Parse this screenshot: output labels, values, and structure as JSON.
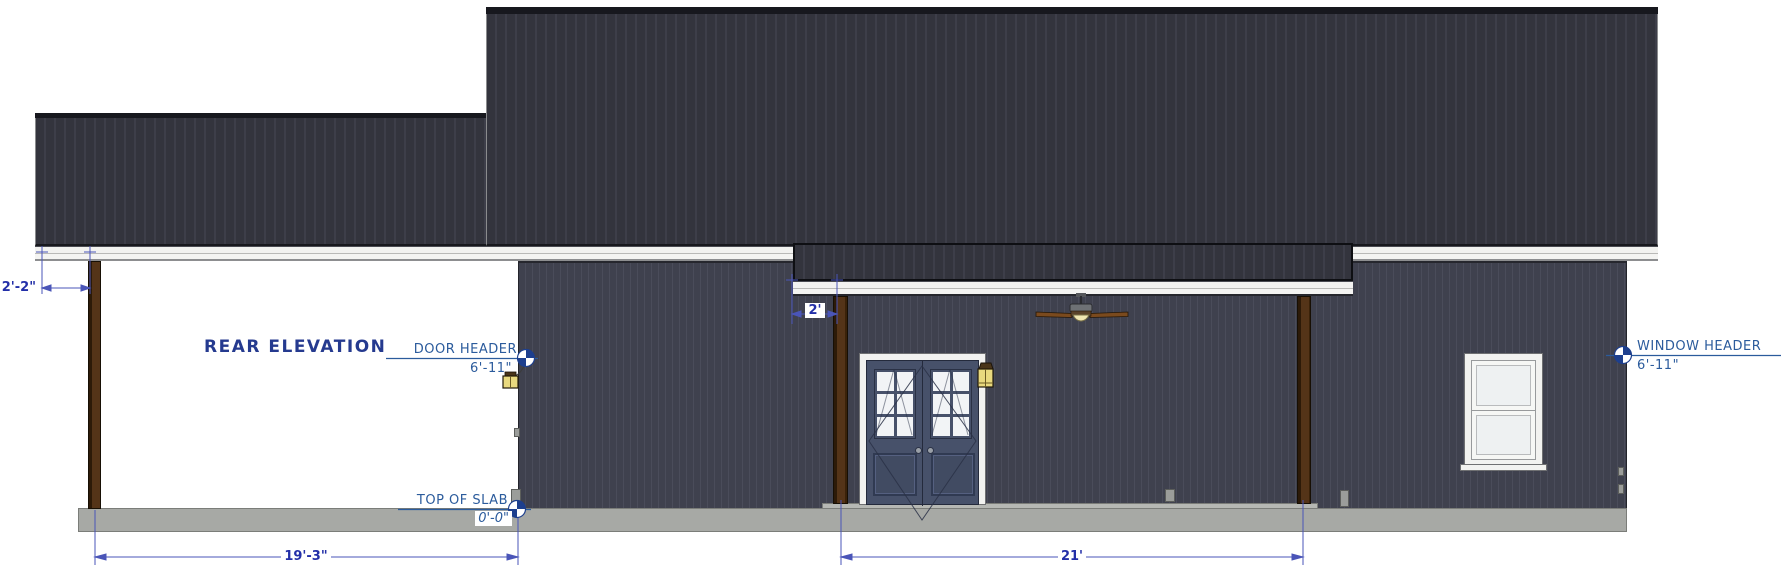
{
  "title": "REAR ELEVATION",
  "callouts": {
    "door_header": {
      "label": "DOOR HEADER",
      "value": "6'-11\""
    },
    "window_header": {
      "label": "WINDOW HEADER",
      "value": "6'-11\""
    },
    "top_of_slab": {
      "label": "TOP OF SLAB",
      "value": "0'-0\""
    }
  },
  "dimensions": {
    "left_overhang": "2'-2\"",
    "center_overhang": "2'",
    "left_porch_width": "19'-3\"",
    "center_porch_width": "21'"
  },
  "colors": {
    "roof": "#33343d",
    "wall": "#3f414e",
    "fascia_white": "#f2f2f0",
    "slab_gray": "#a7a9a5",
    "post_brown": "#543418",
    "door_slate": "#47516a",
    "annotation_blue": "#2b5b9c",
    "dimension_blue": "#232fa8",
    "marker_navy": "#1d3f8e",
    "lantern_yellow": "#e9d97e",
    "fan_blade_brown": "#7a4a1e"
  },
  "icons": {
    "marker": "elevation-datum-marker",
    "fan": "ceiling-fan",
    "lantern": "wall-lantern"
  }
}
